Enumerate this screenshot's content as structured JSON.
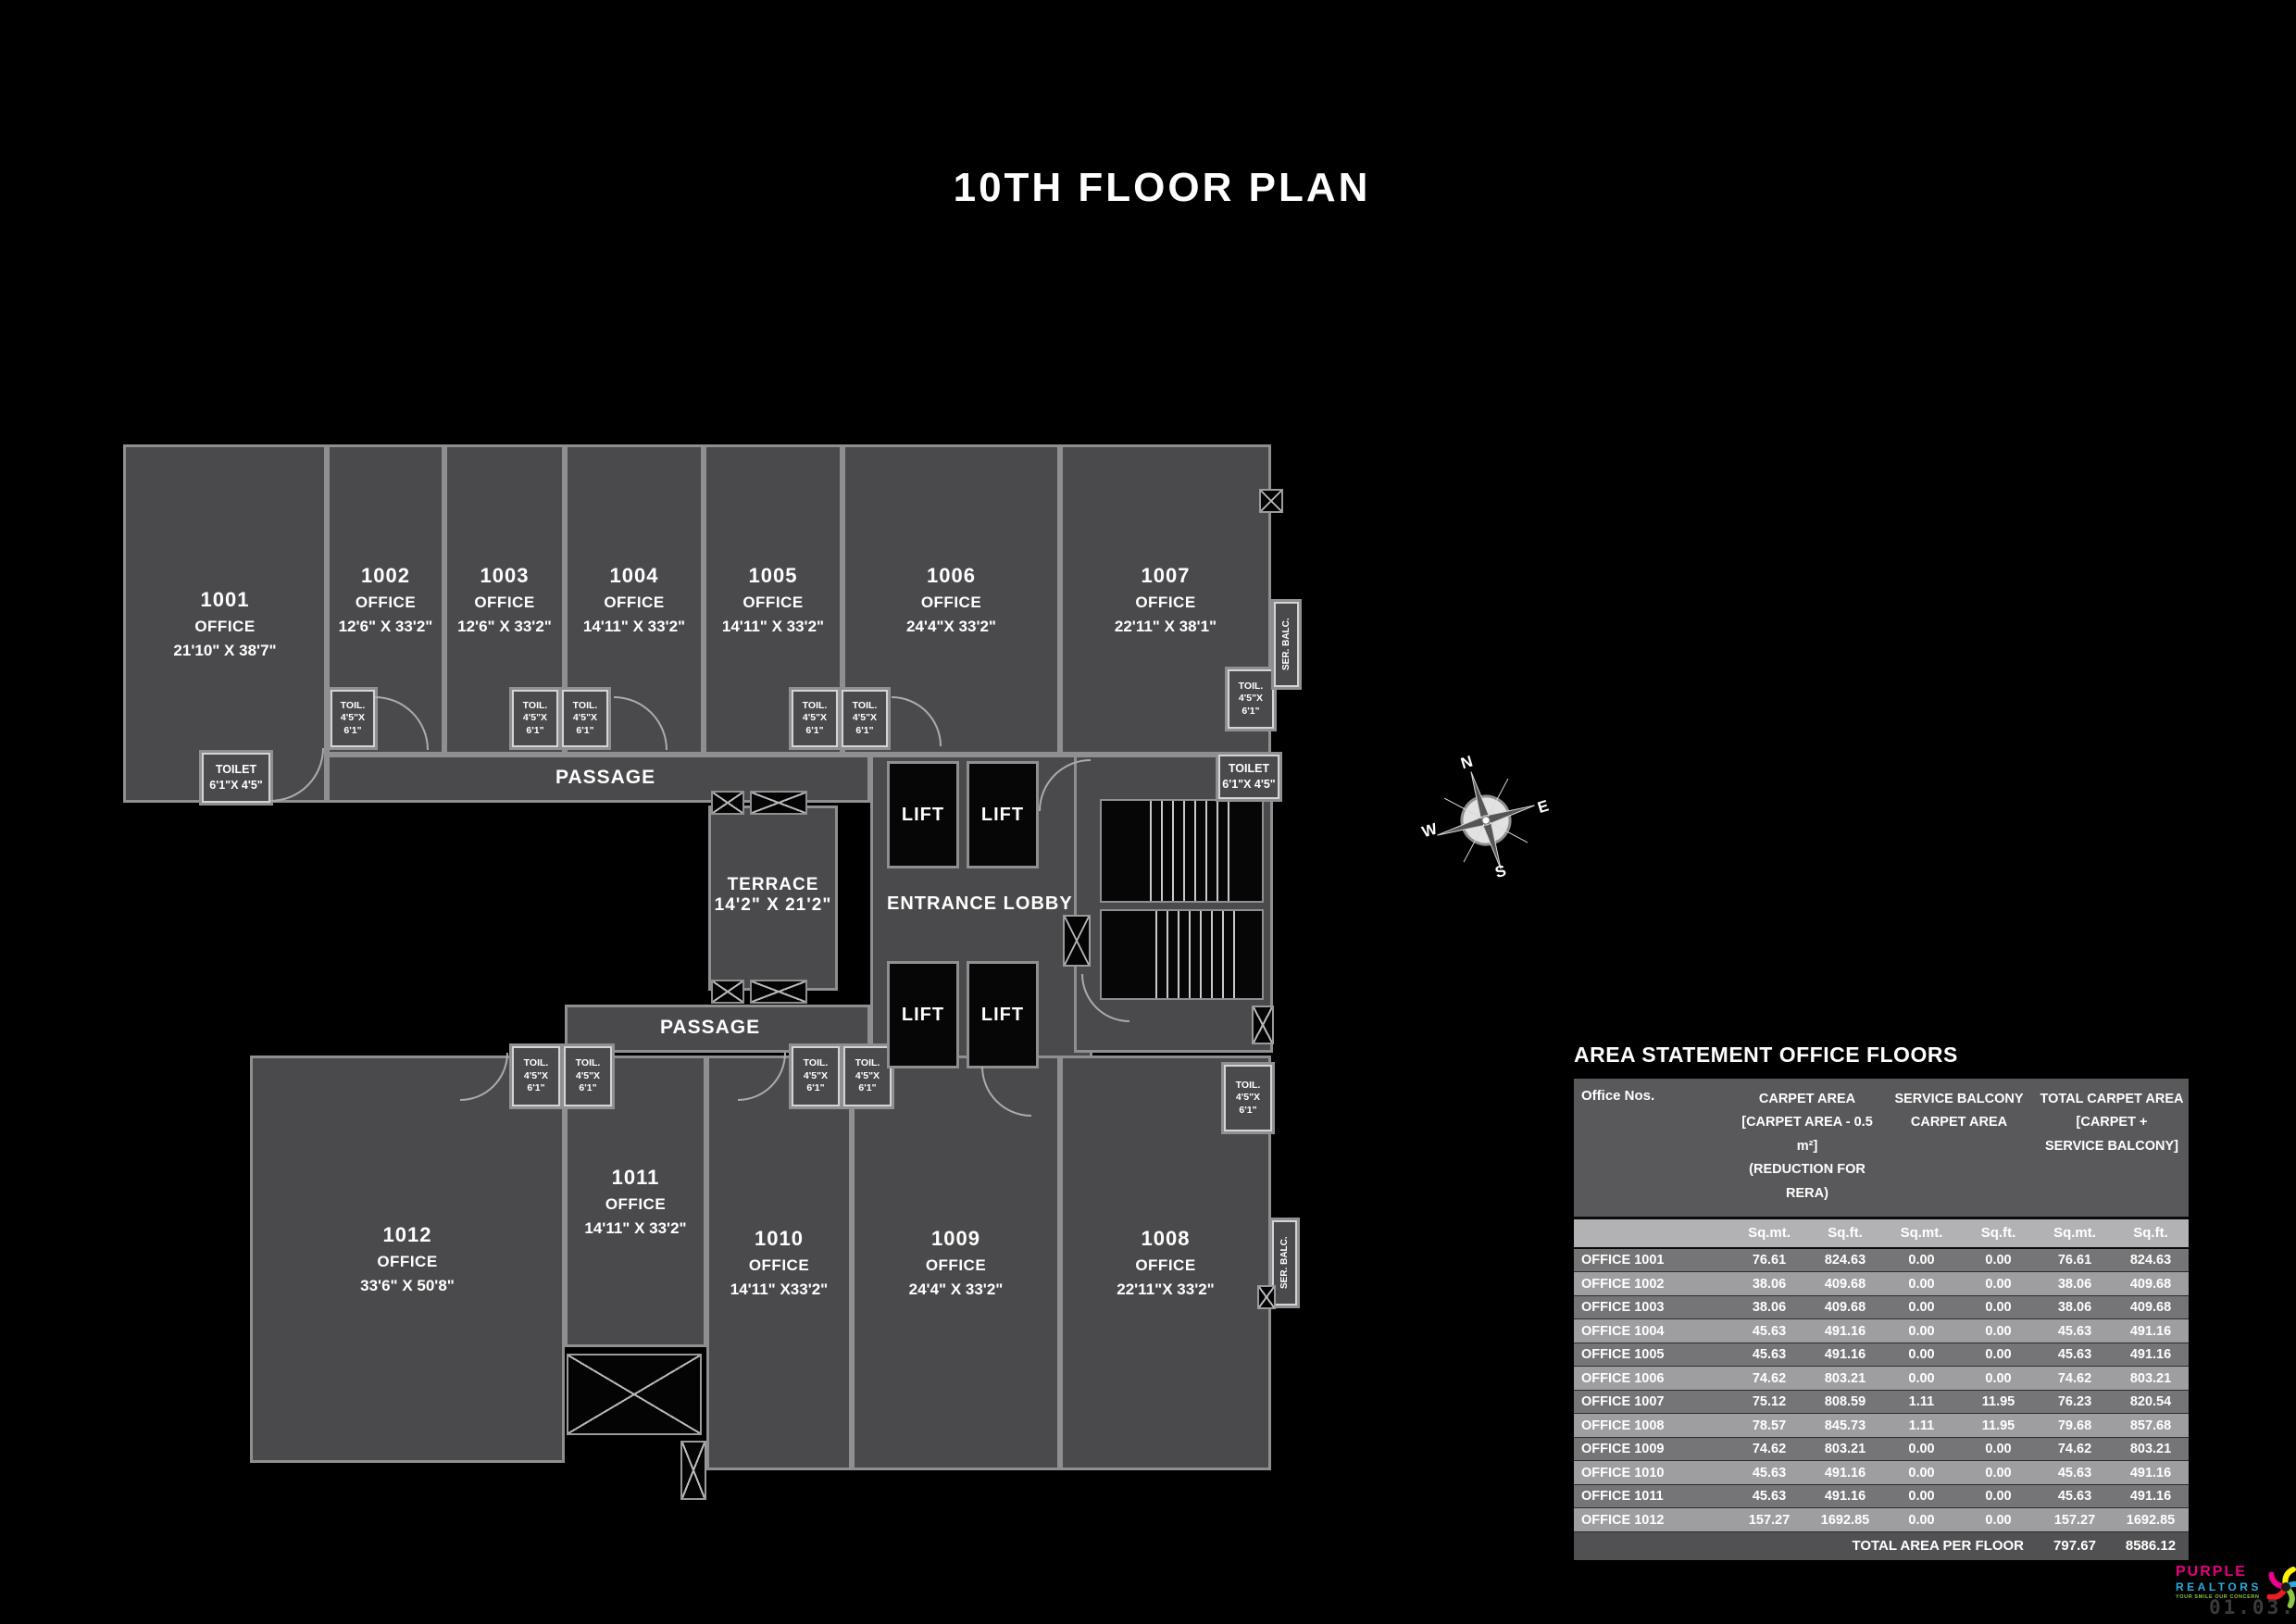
{
  "title": "10TH FLOOR PLAN",
  "plan": {
    "offices": [
      {
        "id": "1001",
        "type": "OFFICE",
        "dims": "21'10\" X 38'7\""
      },
      {
        "id": "1002",
        "type": "OFFICE",
        "dims": "12'6\" X 33'2\""
      },
      {
        "id": "1003",
        "type": "OFFICE",
        "dims": "12'6\" X 33'2\""
      },
      {
        "id": "1004",
        "type": "OFFICE",
        "dims": "14'11\" X 33'2\""
      },
      {
        "id": "1005",
        "type": "OFFICE",
        "dims": "14'11\" X 33'2\""
      },
      {
        "id": "1006",
        "type": "OFFICE",
        "dims": "24'4\"X 33'2\""
      },
      {
        "id": "1007",
        "type": "OFFICE",
        "dims": "22'11\" X 38'1\""
      },
      {
        "id": "1008",
        "type": "OFFICE",
        "dims": "22'11\"X 33'2\""
      },
      {
        "id": "1009",
        "type": "OFFICE",
        "dims": "24'4\" X 33'2\""
      },
      {
        "id": "1010",
        "type": "OFFICE",
        "dims": "14'11\" X33'2\""
      },
      {
        "id": "1011",
        "type": "OFFICE",
        "dims": "14'11\" X 33'2\""
      },
      {
        "id": "1012",
        "type": "OFFICE",
        "dims": "33'6\" X 50'8\""
      }
    ],
    "labels": {
      "passage_top": "PASSAGE",
      "passage_bottom": "PASSAGE",
      "entrance_lobby": "ENTRANCE LOBBY",
      "terrace_name": "TERRACE",
      "terrace_dims": "14'2\" X 21'2\"",
      "lift": "LIFT",
      "ser_balc": "SER. BALC."
    },
    "toil": {
      "l1": "TOIL.",
      "l2": "4'5\"X",
      "l3": "6'1\""
    },
    "toilet": {
      "l1": "TOILET",
      "l2": "6'1\"X 4'5\""
    },
    "compass": {
      "n": "N",
      "e": "E",
      "s": "S",
      "w": "W"
    }
  },
  "table": {
    "title": "AREA STATEMENT OFFICE FLOORS",
    "col1_header": "Office Nos.",
    "groups": [
      {
        "l1": "CARPET AREA",
        "l2": "[CARPET AREA - 0.5 m²]",
        "l3": "(REDUCTION FOR RERA)"
      },
      {
        "l1": "SERVICE BALCONY",
        "l2": "CARPET AREA",
        "l3": ""
      },
      {
        "l1": "TOTAL CARPET AREA",
        "l2": "[CARPET +",
        "l3": "SERVICE BALCONY]"
      }
    ],
    "unit_sqmt": "Sq.mt.",
    "unit_sqft": "Sq.ft.",
    "rows": [
      {
        "office": "OFFICE 1001",
        "c_sqmt": "76.61",
        "c_sqft": "824.63",
        "s_sqmt": "0.00",
        "s_sqft": "0.00",
        "t_sqmt": "76.61",
        "t_sqft": "824.63"
      },
      {
        "office": "OFFICE 1002",
        "c_sqmt": "38.06",
        "c_sqft": "409.68",
        "s_sqmt": "0.00",
        "s_sqft": "0.00",
        "t_sqmt": "38.06",
        "t_sqft": "409.68"
      },
      {
        "office": "OFFICE 1003",
        "c_sqmt": "38.06",
        "c_sqft": "409.68",
        "s_sqmt": "0.00",
        "s_sqft": "0.00",
        "t_sqmt": "38.06",
        "t_sqft": "409.68"
      },
      {
        "office": "OFFICE 1004",
        "c_sqmt": "45.63",
        "c_sqft": "491.16",
        "s_sqmt": "0.00",
        "s_sqft": "0.00",
        "t_sqmt": "45.63",
        "t_sqft": "491.16"
      },
      {
        "office": "OFFICE 1005",
        "c_sqmt": "45.63",
        "c_sqft": "491.16",
        "s_sqmt": "0.00",
        "s_sqft": "0.00",
        "t_sqmt": "45.63",
        "t_sqft": "491.16"
      },
      {
        "office": "OFFICE 1006",
        "c_sqmt": "74.62",
        "c_sqft": "803.21",
        "s_sqmt": "0.00",
        "s_sqft": "0.00",
        "t_sqmt": "74.62",
        "t_sqft": "803.21"
      },
      {
        "office": "OFFICE 1007",
        "c_sqmt": "75.12",
        "c_sqft": "808.59",
        "s_sqmt": "1.11",
        "s_sqft": "11.95",
        "t_sqmt": "76.23",
        "t_sqft": "820.54"
      },
      {
        "office": "OFFICE 1008",
        "c_sqmt": "78.57",
        "c_sqft": "845.73",
        "s_sqmt": "1.11",
        "s_sqft": "11.95",
        "t_sqmt": "79.68",
        "t_sqft": "857.68"
      },
      {
        "office": "OFFICE 1009",
        "c_sqmt": "74.62",
        "c_sqft": "803.21",
        "s_sqmt": "0.00",
        "s_sqft": "0.00",
        "t_sqmt": "74.62",
        "t_sqft": "803.21"
      },
      {
        "office": "OFFICE 1010",
        "c_sqmt": "45.63",
        "c_sqft": "491.16",
        "s_sqmt": "0.00",
        "s_sqft": "0.00",
        "t_sqmt": "45.63",
        "t_sqft": "491.16"
      },
      {
        "office": "OFFICE 1011",
        "c_sqmt": "45.63",
        "c_sqft": "491.16",
        "s_sqmt": "0.00",
        "s_sqft": "0.00",
        "t_sqmt": "45.63",
        "t_sqft": "491.16"
      },
      {
        "office": "OFFICE 1012",
        "c_sqmt": "157.27",
        "c_sqft": "1692.85",
        "s_sqmt": "0.00",
        "s_sqft": "0.00",
        "t_sqmt": "157.27",
        "t_sqft": "1692.85"
      }
    ],
    "total": {
      "label": "TOTAL AREA PER FLOOR",
      "t_sqmt": "797.67",
      "t_sqft": "8586.12"
    }
  },
  "footer": {
    "brand_line1": "PURPLE",
    "brand_line2": "REALTORS",
    "tagline": "YOUR SMILE OUR CONCERN",
    "tm": "TM",
    "date": "01.03.2022"
  },
  "colors": {
    "background": "#000000",
    "room_fill": "#4a4a4c",
    "wall": "#8f8f91",
    "text": "#ffffff",
    "table_header_bg": "#59595b",
    "table_subheader_bg": "#b2b2b4",
    "table_row_odd": "#757577",
    "table_row_even": "#9e9ea0",
    "table_total_bg": "#515153",
    "logo_magenta": "#e6007e",
    "logo_blue": "#29abe2",
    "logo_green": "#8dc63f",
    "date_gray": "#3a3a3a"
  }
}
